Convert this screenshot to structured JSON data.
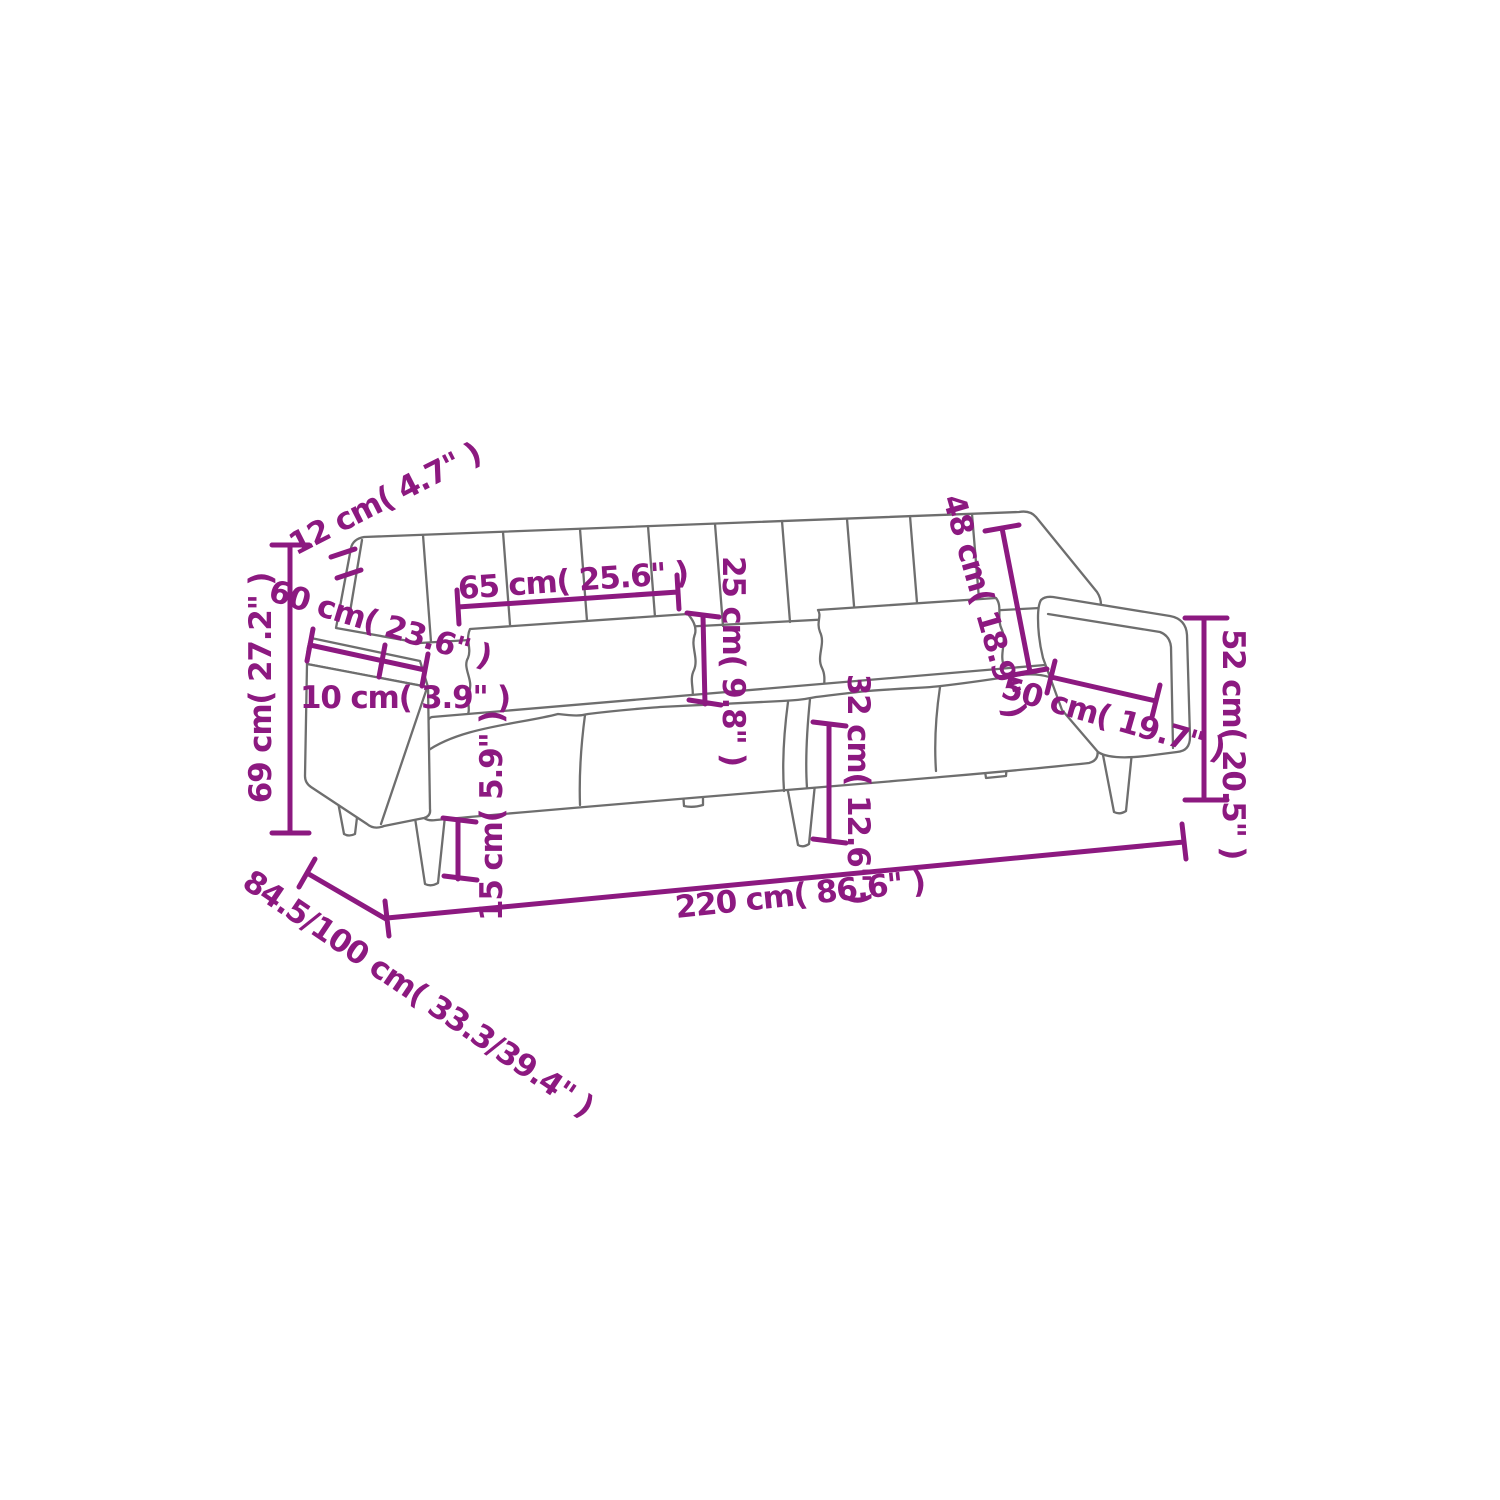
{
  "diagram": {
    "title": "sofa-bed-dimension-diagram",
    "background_color": "#ffffff",
    "line_color": "#6e6e6e",
    "dimension_color": "#8C1980",
    "labels": {
      "backrest_thickness": "12 cm( 4.7\" )",
      "overall_height": "69 cm( 27.2\" )",
      "armrest_depth": "60 cm( 23.6\" )",
      "armrest_width": "10 cm( 3.9\" )",
      "back_cushion_width": "65 cm( 25.6\" )",
      "back_cushion_height": "25 cm( 9.8\" )",
      "backrest_height": "48 cm( 18.9\" )",
      "armrest_length": "50 cm( 19.7\" )",
      "seat_height": "32 cm( 12.6\" )",
      "leg_height": "15 cm( 5.9\" )",
      "armrest_height": "52 cm( 20.5\" )",
      "overall_width": "220 cm( 86.6\" )",
      "depth_seat_bed": "84.5/100 cm( 33.3/39.4\" )"
    }
  }
}
